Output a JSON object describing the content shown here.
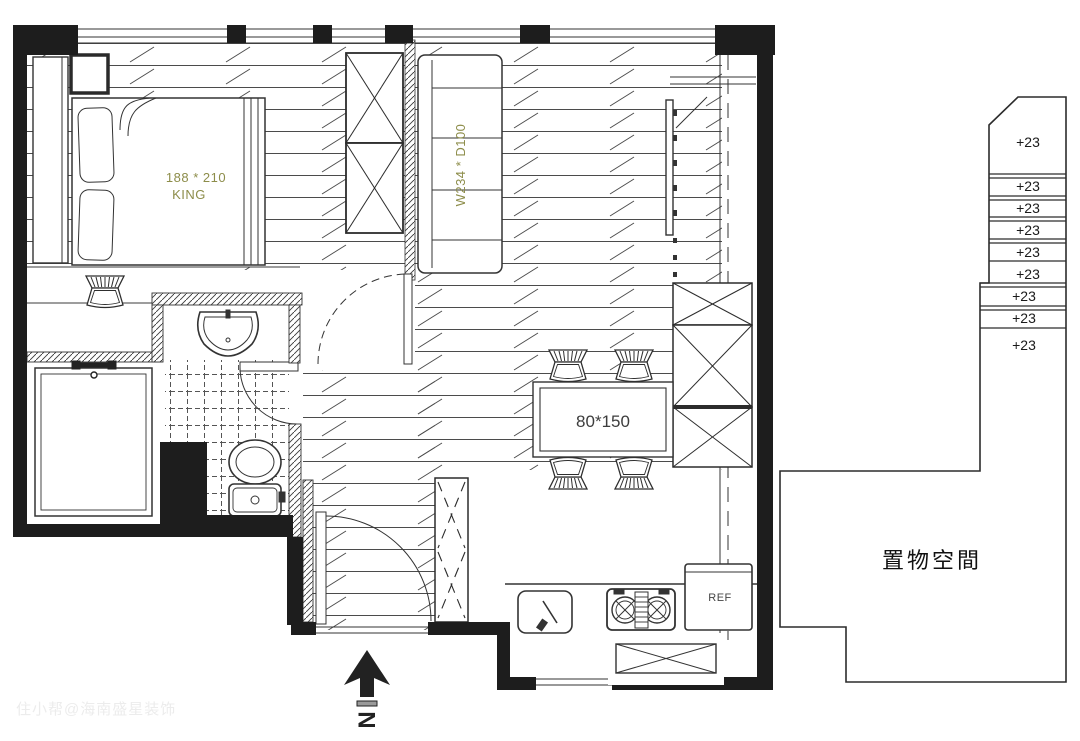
{
  "plan": {
    "bedroom": {
      "bed_size": "188 * 210",
      "bed_type": "KING"
    },
    "living": {
      "sofa_size": "W234 * D100"
    },
    "dining": {
      "table_size": "80*150"
    },
    "kitchen": {
      "fridge_label": "REF"
    },
    "stairs": {
      "labels": [
        "+23",
        "+23",
        "+23",
        "+23",
        "+23",
        "+23",
        "+23",
        "+23",
        "+23"
      ]
    },
    "storage": {
      "label": "置物空間"
    },
    "compass": {
      "north_label": "N"
    },
    "watermark": "住小帮@海南盛星装饰"
  },
  "colors": {
    "wall": "#1d1d1d",
    "line": "#3b3b3b",
    "dimension_label": "#8d8d4a",
    "table_label": "#3d3d3d",
    "watermark": "#ececec"
  }
}
